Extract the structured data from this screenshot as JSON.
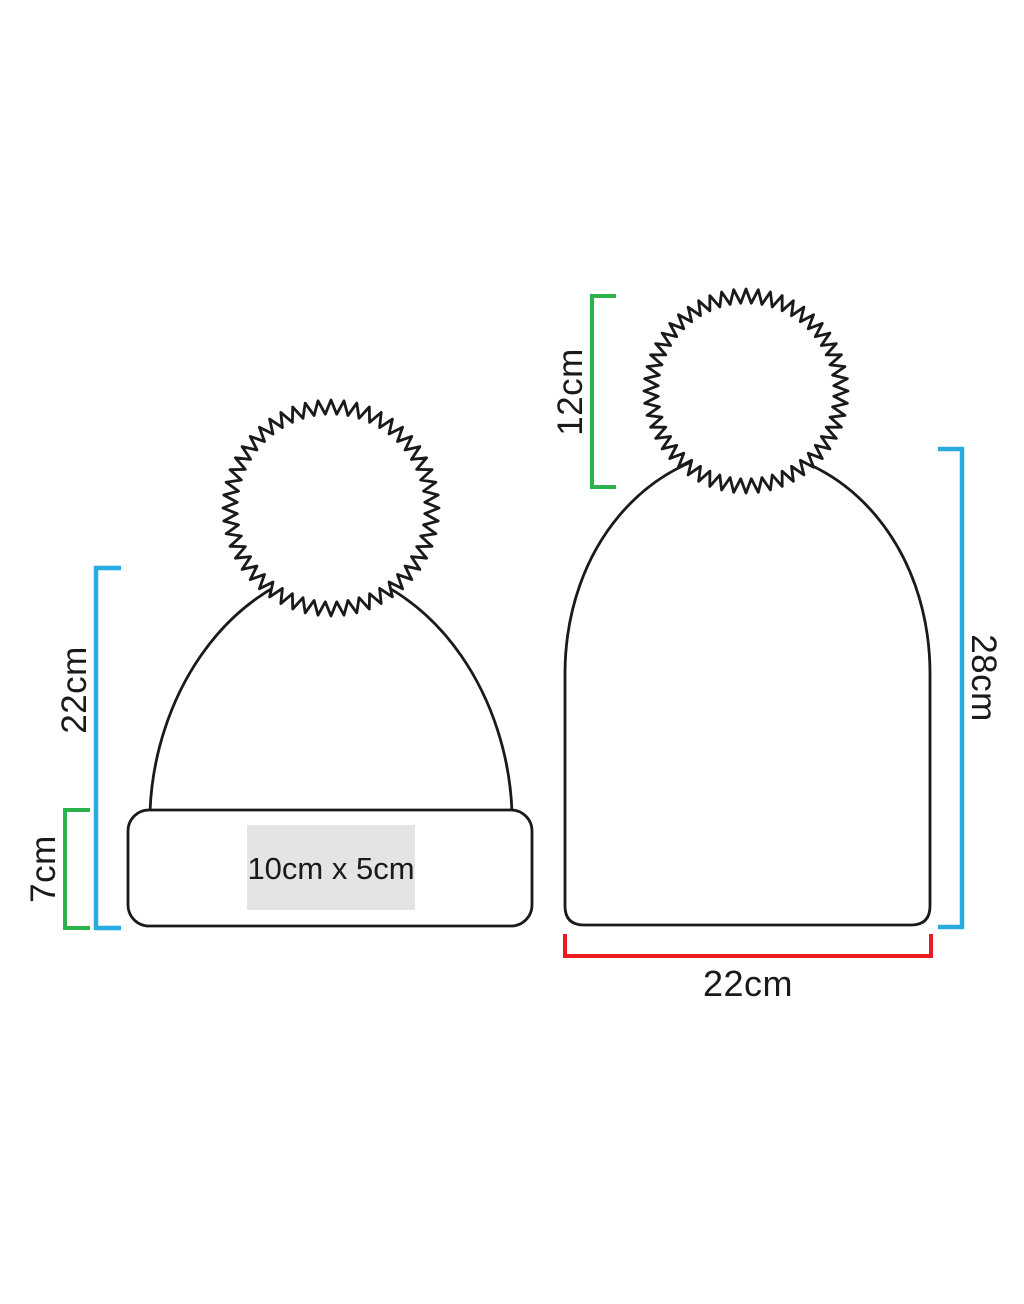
{
  "diagram": {
    "left_beanie": {
      "height_label": "22cm",
      "cuff_height_label": "7cm",
      "print_area_label": "10cm x 5cm"
    },
    "right_beanie": {
      "pom_height_label": "12cm",
      "body_height_label": "28cm",
      "width_label": "22cm"
    },
    "colors": {
      "height_bracket_blue": "#29ABE2",
      "detail_bracket_green": "#2BB24A",
      "width_bracket_red": "#EC1B23",
      "outline_black": "#1a1a1a",
      "print_area_gray": "#E4E4E6"
    }
  }
}
